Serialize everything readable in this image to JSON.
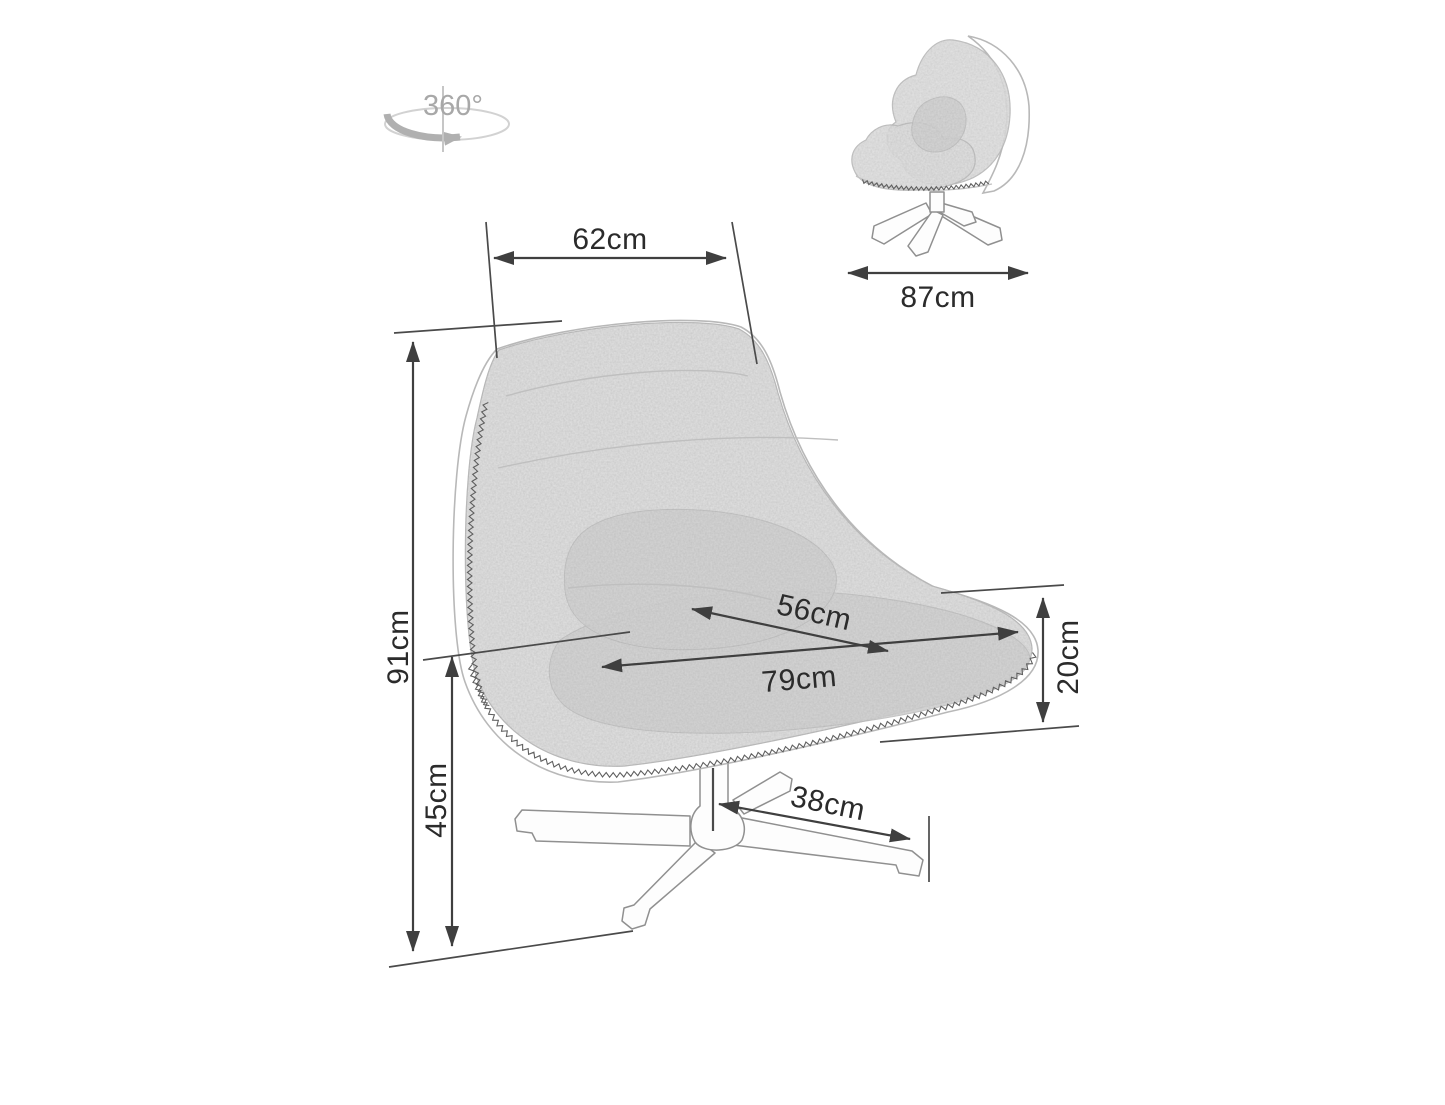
{
  "rotation_icon": {
    "label": "360°"
  },
  "dimensions": {
    "top_width": {
      "text": "62cm"
    },
    "side_depth": {
      "text": "87cm"
    },
    "total_height": {
      "text": "91cm"
    },
    "seat_height": {
      "text": "45cm"
    },
    "seat_depth": {
      "text": "56cm"
    },
    "seat_width": {
      "text": "79cm"
    },
    "cushion_thickness": {
      "text": "20cm"
    },
    "base_leg_length": {
      "text": "38cm"
    }
  },
  "colors": {
    "background": "#ffffff",
    "dimension_line": "#3f3f3f",
    "label_text": "#2b2b2b",
    "rotation_gray": "#a8a8a8",
    "fabric_gray": "#d9d9d9",
    "outline_gray": "#b8b8b8",
    "stitch_gray": "#5f5f5f"
  }
}
